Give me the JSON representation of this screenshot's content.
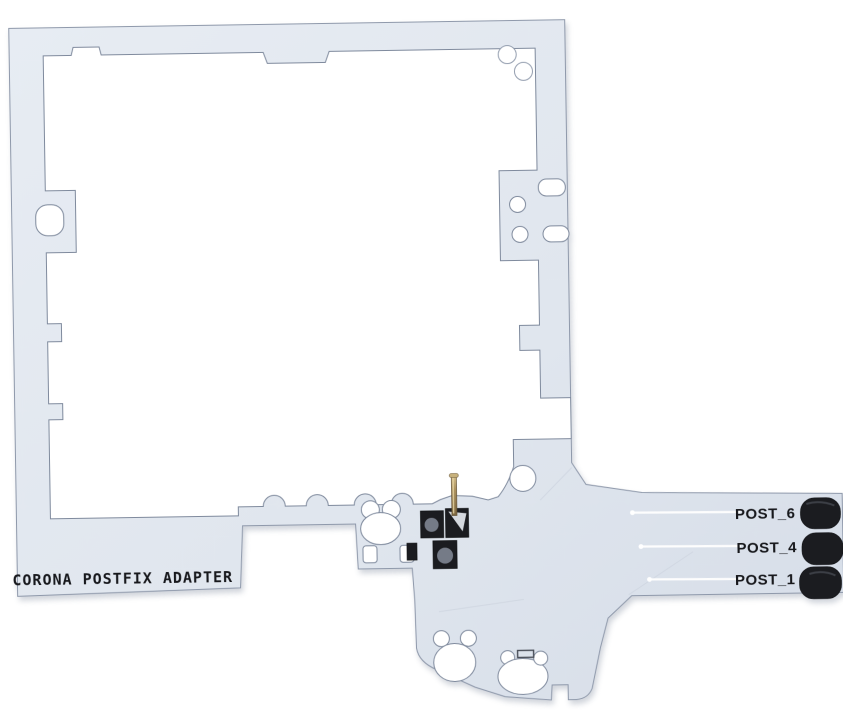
{
  "photo": {
    "subject": "CORONA POSTFIX ADAPTER printed circuit board on white background",
    "background_color": "#ffffff"
  },
  "board": {
    "silkscreen_label": "CORONA POSTFIX ADAPTER",
    "post_points": [
      {
        "label": "POST_6"
      },
      {
        "label": "POST_4"
      },
      {
        "label": "POST_1"
      }
    ],
    "colors": {
      "board_fill": "#e2e7ef",
      "board_shade": "#d8dee9",
      "edge_line": "#8f99ab",
      "pad_black": "#1b1c20",
      "pad_ring_gray": "#757b87",
      "pin_brass": "#9a8153",
      "pin_highlight": "#d9c490",
      "silkscreen_text": "#17181c",
      "shadow": "#aab3c2"
    }
  }
}
